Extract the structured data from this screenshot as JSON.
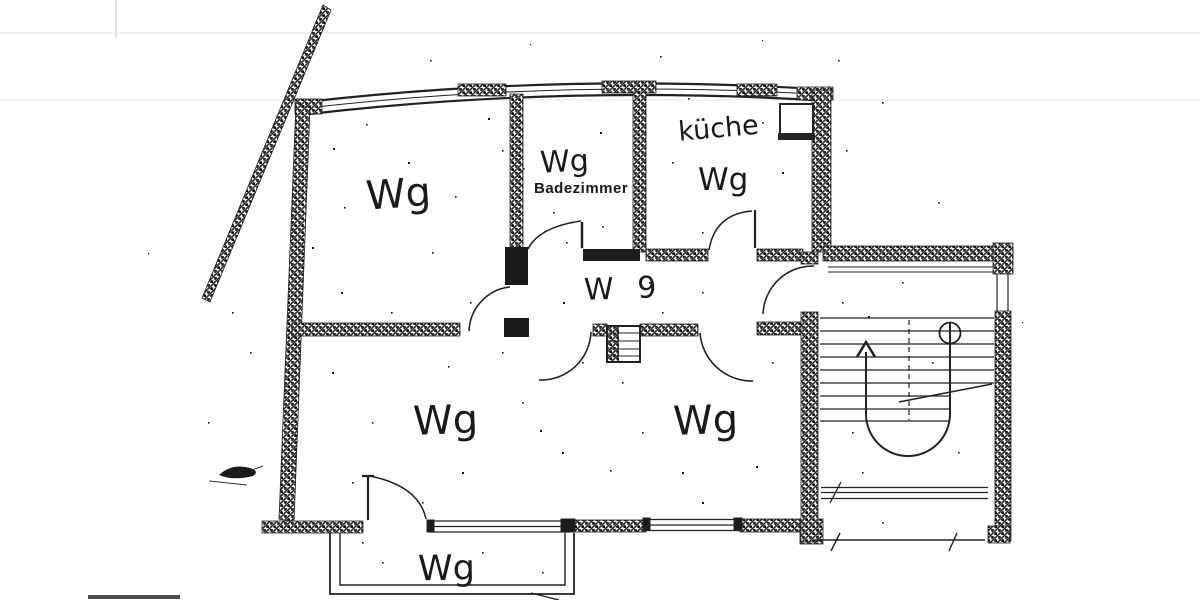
{
  "document": {
    "kind": "scanned hand-drawn floor plan"
  },
  "rooms": {
    "top_left": {
      "label": "Wg"
    },
    "bathroom": {
      "label": "Wg",
      "name": "Badezimmer"
    },
    "kitchen": {
      "name": "küche",
      "label": "Wg"
    },
    "hallway": {
      "label": "W 9"
    },
    "living_left": {
      "label": "Wg"
    },
    "living_right": {
      "label": "Wg"
    },
    "balcony": {
      "label": "Wg"
    }
  },
  "symbols": {
    "stair_direction": "up-arrow",
    "stair_start": "circle-marker",
    "doors": "quarter-arc-swings"
  },
  "colors": {
    "ink": "#1a1a1a",
    "paper": "#ffffff"
  }
}
